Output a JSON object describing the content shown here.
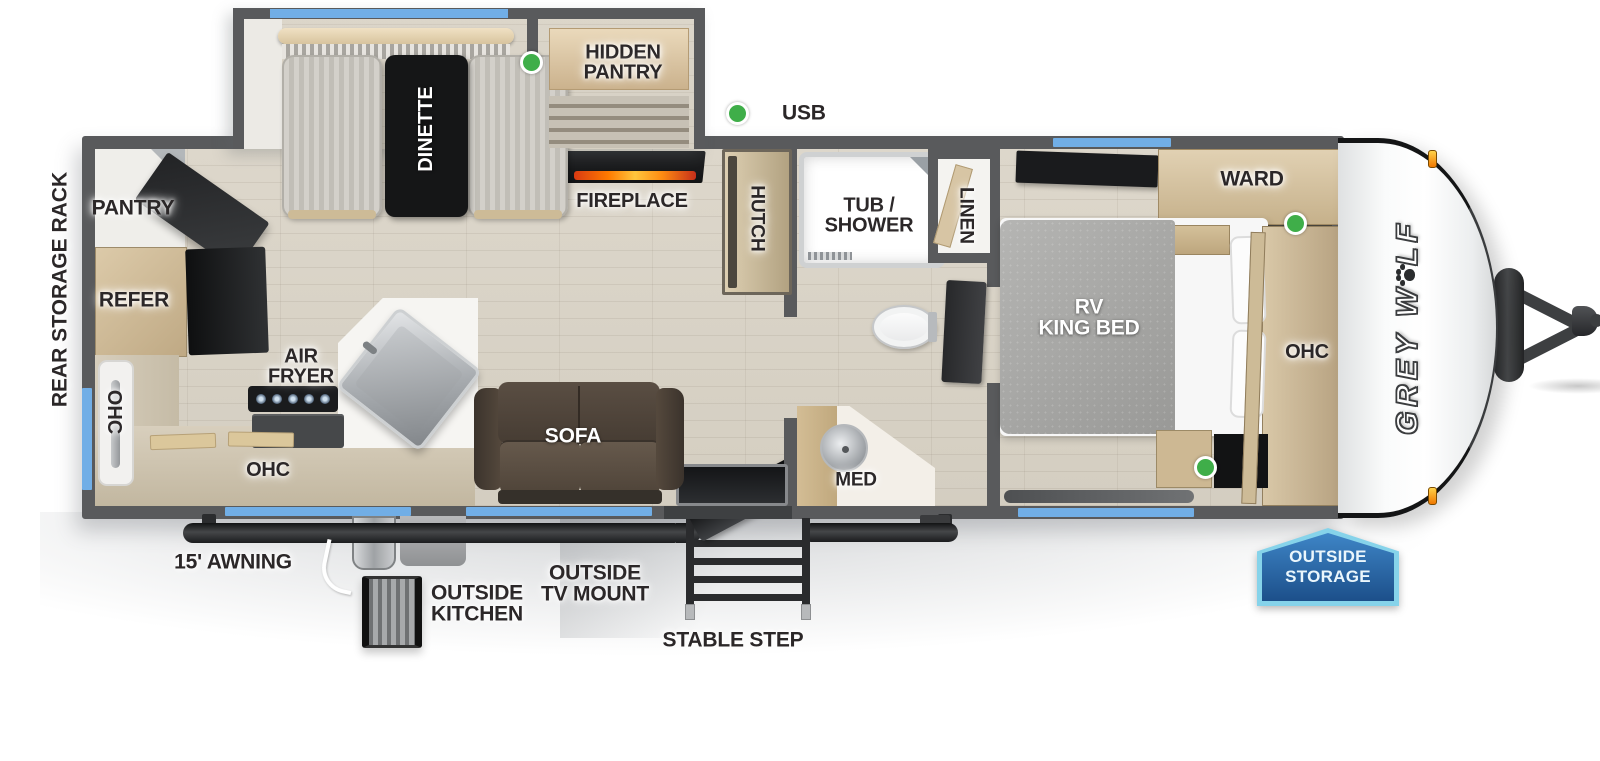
{
  "colors": {
    "wall": "#595a5c",
    "floor": "#d8d2c6",
    "window_blue": "#71aee6",
    "indicator_green": "#3fae49",
    "flame_orange": "#ff7a00",
    "badge_blue": "#2a6cb0",
    "badge_border": "#86d3ea",
    "sofa_brown": "#55493f",
    "wood_light": "#d9c8a8"
  },
  "brand": {
    "logo_start": "GREY W",
    "logo_end": "LF",
    "paw_icon": "paw-print"
  },
  "exterior": {
    "rear_storage_rack": "REAR STORAGE RACK",
    "awning": "15' AWNING",
    "outside_kitchen": "OUTSIDE\nKITCHEN",
    "outside_tv_mount": "OUTSIDE\nTV MOUNT",
    "stable_step": "STABLE STEP",
    "outside_storage": "OUTSIDE\nSTORAGE",
    "usb": "USB"
  },
  "rooms": {
    "living": {
      "dinette": "DINETTE",
      "hidden_pantry": "HIDDEN\nPANTRY",
      "fireplace": "FIREPLACE",
      "hutch": "HUTCH",
      "sofa": "SOFA"
    },
    "kitchen": {
      "pantry": "PANTRY",
      "refer": "REFER",
      "ohc_wall": "OHC",
      "ohc_counter": "OHC",
      "air_fryer": "AIR\nFRYER"
    },
    "bathroom": {
      "tub_shower": "TUB /\nSHOWER",
      "linen": "LINEN",
      "med": "MED"
    },
    "bedroom": {
      "ward": "WARD",
      "bed": "RV\nKING BED",
      "ohc": "OHC"
    }
  }
}
